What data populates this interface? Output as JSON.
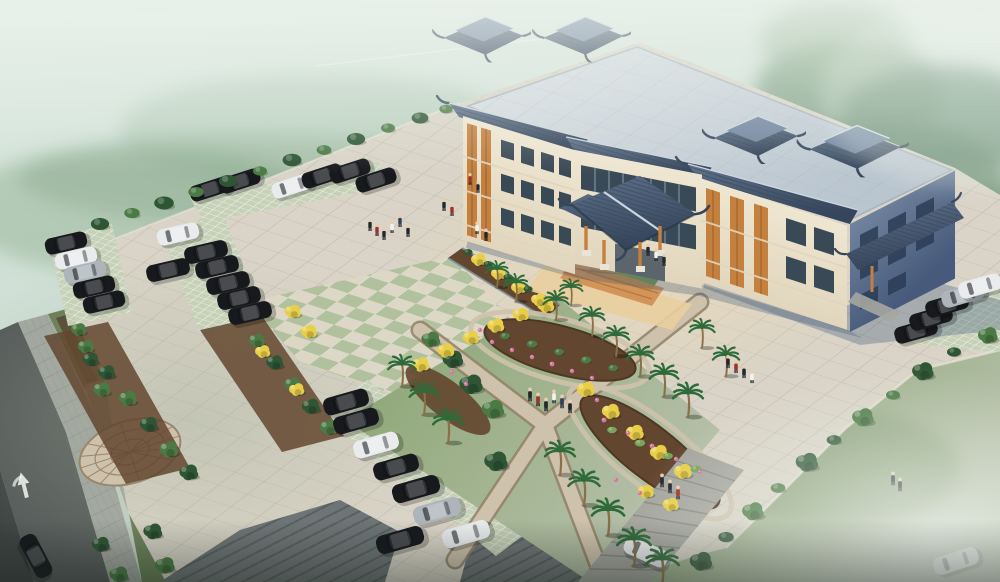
{
  "meta": {
    "scene": "aerial-architectural-rendering",
    "subject": "chinese-style-civic-building-with-entrance-canopy-plaza-gardens-and-parking",
    "setting": "misty-green-landscape"
  },
  "colors": {
    "sky_top": "#dbe9e1",
    "sky_mid": "#cfdfd5",
    "sky_bot": "#c2d1c5",
    "forest_a": "#76997a",
    "forest_b": "#5b8265",
    "forest_c": "#8fae8c",
    "mist_white": "#eef4ee",
    "lawn_a": "#87a26e",
    "lawn_b": "#b7c1ab",
    "grass_dark": "#42503d",
    "verge_green": "#667c52",
    "plaza_base": "#d9d4c7",
    "plaza_warm": "#f2dcb2",
    "plaza_cool": "#a8b29d",
    "tile_line": "#a49d90",
    "check_green": "#adbf9a",
    "check_cream": "#ddd8c6",
    "paver_base": "#c6d1b8",
    "paver_line": "#eef2e6",
    "road": "#555a59",
    "road_edge": "#3e4443",
    "sidewalk": "#a2a6a0",
    "sidewalk_line": "#8b908b",
    "herr_base": "#6e7576",
    "herr_line": "#595f60",
    "mulch": "#63462f",
    "mulch_dark": "#4d3723",
    "foliage_dark": "#2e5634",
    "foliage_mid": "#4b7a44",
    "foliage_light": "#79a458",
    "yellow_a": "#e9cf48",
    "palm_green": "#2f6b3a",
    "trunk": "#8a7048",
    "pink": "#d678a2",
    "cobble_base": "#cec2ac",
    "cobble_line": "#97876c",
    "path_edge": "#94846a",
    "lawn_patch": "#71994c",
    "building_cream": "#efe6d1",
    "building_cream2": "#e1d6bd",
    "roof_slab_a": "#d8dee2",
    "roof_slab_b": "#b9c5cf",
    "roof_line": "#a8b2bc",
    "tile_a": "#5d7189",
    "tile_b": "#35455b",
    "tile_ridge": "#cdd6de",
    "wall_end_a": "#70849f",
    "wall_end_b": "#475a7b",
    "window_dark": "#3a4956",
    "glass": "#7e97ab",
    "wood": "#c3803f",
    "wood_dark": "#96571f",
    "apron": "#e9cf9e",
    "apron_warm": "#cf8a4e",
    "shadow_blue": "#3c5578",
    "car_dark": "#17191d",
    "car_white": "#e9ebed",
    "car_silver": "#adb4ba",
    "people_dark": "#23282e",
    "red_acc": "#a03328",
    "white": "#f2f2f0",
    "navy": "#30405c",
    "curb_light": "#e9e4d8",
    "steps_stone": "#a5a69e",
    "steps_line": "#84857d"
  },
  "scene": {
    "cars": [
      [
        210,
        189,
        -18,
        0.9,
        "car_dark"
      ],
      [
        240,
        181,
        -18,
        0.9,
        "car_dark"
      ],
      [
        292,
        186,
        -18,
        0.9,
        "car_white"
      ],
      [
        322,
        176,
        -18,
        0.9,
        "car_dark"
      ],
      [
        350,
        171,
        -18,
        0.9,
        "car_dark"
      ],
      [
        376,
        180,
        -18,
        0.9,
        "car_dark"
      ],
      [
        66,
        243,
        -13,
        0.92,
        "car_dark"
      ],
      [
        76,
        258,
        -13,
        0.92,
        "car_white"
      ],
      [
        85,
        272,
        -13,
        0.92,
        "car_silver"
      ],
      [
        94,
        287,
        -13,
        0.92,
        "car_dark"
      ],
      [
        104,
        302,
        -13,
        0.92,
        "car_dark"
      ],
      [
        168,
        270,
        -13,
        0.95,
        "car_dark"
      ],
      [
        178,
        234,
        -13,
        0.92,
        "car_white"
      ],
      [
        206,
        252,
        -13,
        0.95,
        "car_dark"
      ],
      [
        217,
        267,
        -13,
        0.95,
        "car_dark"
      ],
      [
        228,
        283,
        -13,
        0.95,
        "car_dark"
      ],
      [
        239,
        298,
        -13,
        0.95,
        "car_dark"
      ],
      [
        250,
        313,
        -13,
        0.95,
        "car_dark"
      ],
      [
        346,
        402,
        -16,
        1.0,
        "car_dark"
      ],
      [
        356,
        421,
        -16,
        1.0,
        "car_dark"
      ],
      [
        376,
        445,
        -16,
        1.0,
        "car_white"
      ],
      [
        396,
        467,
        -16,
        1.0,
        "car_dark"
      ],
      [
        416,
        489,
        -16,
        1.05,
        "car_dark"
      ],
      [
        437,
        511,
        -16,
        1.05,
        "car_silver"
      ],
      [
        400,
        540,
        -16,
        1.05,
        "car_dark"
      ],
      [
        466,
        534,
        -16,
        1.05,
        "car_white"
      ],
      [
        916,
        331,
        -16,
        0.95,
        "car_dark"
      ],
      [
        931,
        318,
        -16,
        0.95,
        "car_dark"
      ],
      [
        947,
        305,
        -16,
        0.95,
        "car_dark"
      ],
      [
        963,
        295,
        -16,
        0.95,
        "car_silver"
      ],
      [
        980,
        286,
        -16,
        0.95,
        "car_white"
      ],
      [
        36,
        556,
        62,
        1.0,
        "car_dark"
      ],
      [
        646,
        552,
        24,
        1.0,
        "car_white"
      ],
      [
        956,
        561,
        -18,
        1.0,
        "car_white"
      ]
    ],
    "trees": [
      [
        78,
        330,
        0,
        0.85,
        "foliage_mid"
      ],
      [
        90,
        360,
        0,
        0.9,
        "foliage_dark"
      ],
      [
        101,
        390,
        0,
        0.95,
        "foliage_mid"
      ],
      [
        152,
        532,
        0,
        1.05,
        "foliage_dark"
      ],
      [
        164,
        566,
        0,
        1.1,
        "foliage_mid"
      ],
      [
        100,
        545,
        0,
        1.0,
        "foliage_dark"
      ],
      [
        118,
        575,
        0,
        1.05,
        "foliage_mid"
      ],
      [
        85,
        347,
        0,
        0.9,
        "foliage_mid"
      ],
      [
        106,
        373,
        0,
        0.95,
        "foliage_dark"
      ],
      [
        127,
        399,
        0,
        1.0,
        "foliage_mid"
      ],
      [
        148,
        425,
        0,
        1.0,
        "foliage_dark"
      ],
      [
        168,
        450,
        0,
        1.05,
        "foliage_mid"
      ],
      [
        188,
        473,
        0,
        1.05,
        "foliage_dark"
      ],
      [
        256,
        341,
        0,
        0.9,
        "foliage_mid"
      ],
      [
        274,
        363,
        0,
        0.95,
        "foliage_dark"
      ],
      [
        292,
        385,
        0,
        0.95,
        "foliage_mid"
      ],
      [
        310,
        407,
        0,
        1.0,
        "foliage_dark"
      ],
      [
        328,
        428,
        0,
        1.0,
        "foliage_mid"
      ],
      [
        430,
        340,
        0,
        1.05,
        "foliage_mid"
      ],
      [
        452,
        360,
        0,
        1.15,
        "foliage_dark"
      ],
      [
        470,
        385,
        0,
        1.3,
        "foliage_dark"
      ],
      [
        492,
        410,
        0,
        1.25,
        "foliage_mid"
      ],
      [
        495,
        462,
        0,
        1.3,
        "foliage_dark"
      ],
      [
        987,
        336,
        0,
        1.1,
        "foliage_mid"
      ],
      [
        922,
        372,
        0,
        1.2,
        "foliage_dark"
      ],
      [
        862,
        418,
        0,
        1.2,
        "foliage_mid"
      ],
      [
        806,
        463,
        0,
        1.25,
        "foliage_dark"
      ],
      [
        752,
        512,
        0,
        1.2,
        "foliage_mid"
      ],
      [
        700,
        562,
        0,
        1.25,
        "foliage_dark"
      ]
    ],
    "shrubs": [
      [
        100,
        224,
        0,
        1.3,
        "foliage_dark"
      ],
      [
        132,
        213,
        0,
        1.1,
        "foliage_mid"
      ],
      [
        164,
        203,
        0,
        1.4,
        "foliage_dark"
      ],
      [
        196,
        192,
        0,
        1.1,
        "foliage_mid"
      ],
      [
        228,
        181,
        0,
        1.3,
        "foliage_dark"
      ],
      [
        260,
        171,
        0,
        1.0,
        "foliage_mid"
      ],
      [
        292,
        160,
        0,
        1.35,
        "foliage_dark"
      ],
      [
        324,
        150,
        0,
        1.05,
        "foliage_mid"
      ],
      [
        356,
        139,
        0,
        1.3,
        "foliage_dark"
      ],
      [
        388,
        128,
        0,
        1.0,
        "foliage_mid"
      ],
      [
        420,
        118,
        0,
        1.2,
        "foliage_dark"
      ],
      [
        446,
        109,
        0,
        0.95,
        "foliage_mid"
      ],
      [
        954,
        352,
        0,
        1.0,
        "foliage_dark"
      ],
      [
        893,
        395,
        0,
        1.0,
        "foliage_mid"
      ],
      [
        834,
        440,
        0,
        1.05,
        "foliage_dark"
      ],
      [
        778,
        488,
        0,
        1.05,
        "foliage_mid"
      ],
      [
        726,
        537,
        0,
        1.1,
        "foliage_dark"
      ],
      [
        505,
        336,
        0,
        0.7,
        "foliage_mid"
      ],
      [
        532,
        344,
        0,
        0.75,
        "foliage_mid"
      ],
      [
        559,
        352,
        0,
        0.7,
        "foliage_mid"
      ],
      [
        586,
        360,
        0,
        0.75,
        "foliage_mid"
      ],
      [
        613,
        368,
        0,
        0.7,
        "foliage_mid"
      ],
      [
        612,
        430,
        0,
        0.7,
        "foliage_light"
      ],
      [
        640,
        443,
        0,
        0.75,
        "foliage_light"
      ],
      [
        668,
        456,
        0,
        0.7,
        "foliage_light"
      ],
      [
        696,
        469,
        0,
        0.75,
        "foliage_light"
      ],
      [
        468,
        252,
        0,
        0.65,
        "foliage_dark"
      ],
      [
        488,
        264,
        0,
        0.65,
        "foliage_dark"
      ],
      [
        508,
        277,
        0,
        0.65,
        "foliage_dark"
      ],
      [
        528,
        289,
        0,
        0.65,
        "foliage_dark"
      ]
    ],
    "yellow_trees": [
      [
        420,
        365,
        0,
        0.95,
        "yellow_a"
      ],
      [
        445,
        351,
        0,
        0.95,
        "yellow_a"
      ],
      [
        470,
        338,
        0,
        0.9,
        "yellow_a"
      ],
      [
        495,
        326,
        0,
        0.95,
        "yellow_a"
      ],
      [
        520,
        315,
        0,
        0.9,
        "yellow_a"
      ],
      [
        545,
        306,
        0,
        0.95,
        "yellow_a"
      ],
      [
        585,
        390,
        0,
        1.0,
        "yellow_a"
      ],
      [
        610,
        412,
        0,
        1.0,
        "yellow_a"
      ],
      [
        634,
        433,
        0,
        1.0,
        "yellow_a"
      ],
      [
        658,
        453,
        0,
        1.0,
        "yellow_a"
      ],
      [
        682,
        472,
        0,
        1.0,
        "yellow_a"
      ],
      [
        645,
        492,
        0,
        0.9,
        "yellow_a"
      ],
      [
        670,
        505,
        0,
        0.9,
        "yellow_a"
      ],
      [
        478,
        260,
        0,
        0.85,
        "yellow_a"
      ],
      [
        498,
        274,
        0,
        0.85,
        "yellow_a"
      ],
      [
        518,
        288,
        0,
        0.85,
        "yellow_a"
      ],
      [
        538,
        300,
        0,
        0.85,
        "yellow_a"
      ],
      [
        292,
        312,
        0,
        0.9,
        "yellow_a"
      ],
      [
        308,
        332,
        0,
        0.9,
        "yellow_a"
      ],
      [
        262,
        352,
        0,
        0.85,
        "yellow_a"
      ],
      [
        296,
        390,
        0,
        0.85,
        "yellow_a"
      ]
    ],
    "palms": [
      [
        497,
        282,
        0,
        1.0,
        "palm_green"
      ],
      [
        516,
        296,
        0,
        1.05,
        "palm_green"
      ],
      [
        556,
        314,
        0,
        1.1,
        "palm_green"
      ],
      [
        571,
        300,
        0,
        1.0,
        "palm_green"
      ],
      [
        592,
        330,
        0,
        1.1,
        "palm_green"
      ],
      [
        616,
        350,
        0,
        1.15,
        "palm_green"
      ],
      [
        640,
        370,
        0,
        1.2,
        "palm_green"
      ],
      [
        664,
        390,
        0,
        1.25,
        "palm_green"
      ],
      [
        688,
        410,
        0,
        1.3,
        "palm_green"
      ],
      [
        702,
        342,
        0,
        1.1,
        "palm_green"
      ],
      [
        726,
        370,
        0,
        1.15,
        "palm_green"
      ],
      [
        402,
        380,
        0,
        1.2,
        "palm_green"
      ],
      [
        424,
        408,
        0,
        1.25,
        "palm_green"
      ],
      [
        448,
        436,
        0,
        1.3,
        "palm_green"
      ],
      [
        560,
        468,
        0,
        1.3,
        "palm_green"
      ],
      [
        584,
        498,
        0,
        1.35,
        "palm_green"
      ],
      [
        608,
        528,
        0,
        1.4,
        "palm_green"
      ],
      [
        634,
        558,
        0,
        1.45,
        "palm_green"
      ],
      [
        662,
        578,
        0,
        1.45,
        "palm_green"
      ]
    ],
    "flowers": [
      [
        492,
        342,
        0,
        1,
        "pink"
      ],
      [
        512,
        350,
        0,
        1,
        "pink"
      ],
      [
        532,
        357,
        0,
        1,
        "pink"
      ],
      [
        552,
        364,
        0,
        1.1,
        "pink"
      ],
      [
        572,
        371,
        0,
        1,
        "pink"
      ],
      [
        592,
        378,
        0,
        1,
        "pink"
      ],
      [
        604,
        420,
        0,
        1.1,
        "pink"
      ],
      [
        628,
        433,
        0,
        1,
        "pink"
      ],
      [
        652,
        446,
        0,
        1.1,
        "pink"
      ],
      [
        676,
        459,
        0,
        1,
        "pink"
      ],
      [
        700,
        472,
        0,
        1,
        "pink"
      ],
      [
        597,
        400,
        0,
        1,
        "pink"
      ],
      [
        480,
        330,
        0,
        1,
        "pink"
      ],
      [
        616,
        480,
        0,
        1,
        "pink"
      ],
      [
        640,
        493,
        0,
        1,
        "pink"
      ],
      [
        452,
        372,
        0,
        1,
        "pink"
      ],
      [
        466,
        384,
        0,
        1,
        "pink"
      ]
    ],
    "people": [
      [
        370,
        228,
        0,
        1,
        "people_dark"
      ],
      [
        377,
        233,
        0,
        1,
        "red_acc"
      ],
      [
        384,
        237,
        0,
        1,
        "people_dark"
      ],
      [
        392,
        230,
        0,
        1,
        "white"
      ],
      [
        400,
        224,
        0,
        1,
        "navy"
      ],
      [
        408,
        234,
        0,
        1,
        "people_dark"
      ],
      [
        444,
        208,
        0,
        1,
        "people_dark"
      ],
      [
        452,
        213,
        0,
        1,
        "red_acc"
      ],
      [
        477,
        231,
        0,
        1,
        "white"
      ],
      [
        486,
        238,
        0,
        1,
        "people_dark"
      ],
      [
        470,
        182,
        0,
        0.95,
        "red_acc"
      ],
      [
        478,
        190,
        0,
        0.95,
        "people_dark"
      ],
      [
        648,
        253,
        0,
        1,
        "people_dark"
      ],
      [
        656,
        258,
        0,
        1,
        "white"
      ],
      [
        664,
        263,
        0,
        1,
        "people_dark"
      ],
      [
        728,
        365,
        0,
        1.05,
        "people_dark"
      ],
      [
        736,
        370,
        0,
        1.05,
        "red_acc"
      ],
      [
        744,
        375,
        0,
        1.05,
        "people_dark"
      ],
      [
        752,
        380,
        0,
        1.05,
        "white"
      ],
      [
        530,
        398,
        0,
        1.1,
        "people_dark"
      ],
      [
        538,
        403,
        0,
        1.1,
        "red_acc"
      ],
      [
        546,
        408,
        0,
        1.1,
        "people_dark"
      ],
      [
        554,
        400,
        0,
        1.1,
        "white"
      ],
      [
        562,
        405,
        0,
        1.1,
        "navy"
      ],
      [
        570,
        410,
        0,
        1.1,
        "people_dark"
      ],
      [
        662,
        484,
        0,
        1.1,
        "people_dark"
      ],
      [
        670,
        490,
        0,
        1.1,
        "people_dark"
      ],
      [
        678,
        496,
        0,
        1.1,
        "red_acc"
      ],
      [
        893,
        482,
        0,
        1.1,
        "people_dark"
      ],
      [
        900,
        488,
        0,
        1.1,
        "people_dark"
      ]
    ]
  }
}
